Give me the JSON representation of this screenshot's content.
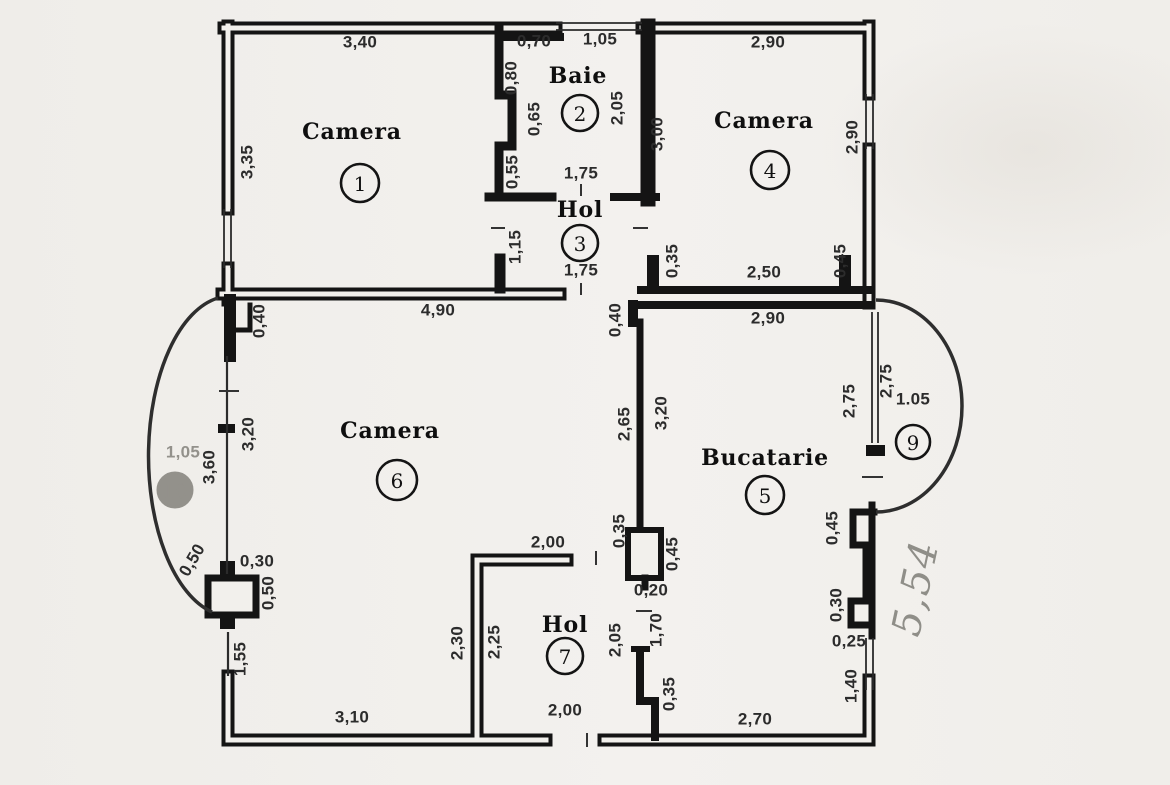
{
  "drawing": {
    "title_hint": "apartment floor plan (scanned)",
    "colors": {
      "paper": "#f2f0ec",
      "ink": "#141414",
      "pencil": "#8f8e88"
    },
    "rooms": [
      {
        "name": "Camera",
        "number": "1",
        "name_x": 352,
        "name_y": 132,
        "num_x": 360,
        "num_y": 183,
        "r": 19,
        "faint": false
      },
      {
        "name": "Baie",
        "number": "2",
        "name_x": 578,
        "name_y": 76,
        "num_x": 580,
        "num_y": 113,
        "r": 18,
        "faint": false
      },
      {
        "name": "Hol",
        "number": "3",
        "name_x": 580,
        "name_y": 210,
        "num_x": 580,
        "num_y": 243,
        "r": 18,
        "faint": false
      },
      {
        "name": "Camera",
        "number": "4",
        "name_x": 764,
        "name_y": 121,
        "num_x": 770,
        "num_y": 170,
        "r": 19,
        "faint": false
      },
      {
        "name": "Bucatarie",
        "number": "5",
        "name_x": 765,
        "name_y": 458,
        "num_x": 765,
        "num_y": 495,
        "r": 19,
        "faint": false
      },
      {
        "name": "Camera",
        "number": "6",
        "name_x": 390,
        "name_y": 431,
        "num_x": 397,
        "num_y": 480,
        "r": 20,
        "faint": false
      },
      {
        "name": "Hol",
        "number": "7",
        "name_x": 565,
        "name_y": 625,
        "num_x": 565,
        "num_y": 656,
        "r": 18,
        "faint": false
      },
      {
        "name": "",
        "number": "9",
        "name_x": 0,
        "name_y": 0,
        "num_x": 913,
        "num_y": 442,
        "r": 17,
        "faint": false
      },
      {
        "name": "",
        "number": "10",
        "name_x": 0,
        "name_y": 0,
        "num_x": 175,
        "num_y": 490,
        "r": 17,
        "faint": true
      }
    ],
    "dimensions": [
      {
        "text": "3,40",
        "x": 360,
        "y": 42,
        "rot": 0,
        "faint": false
      },
      {
        "text": "0,70",
        "x": 534,
        "y": 41,
        "rot": 0,
        "faint": false
      },
      {
        "text": "1,05",
        "x": 600,
        "y": 39,
        "rot": 0,
        "faint": false
      },
      {
        "text": "2,90",
        "x": 768,
        "y": 42,
        "rot": 0,
        "faint": false
      },
      {
        "text": "3,35",
        "x": 247,
        "y": 162,
        "rot": -90,
        "faint": false
      },
      {
        "text": "0,80",
        "x": 511,
        "y": 78,
        "rot": -90,
        "faint": false
      },
      {
        "text": "0,65",
        "x": 534,
        "y": 119,
        "rot": -90,
        "faint": false
      },
      {
        "text": "0,55",
        "x": 512,
        "y": 172,
        "rot": -90,
        "faint": false
      },
      {
        "text": "2,05",
        "x": 617,
        "y": 108,
        "rot": -90,
        "faint": false
      },
      {
        "text": "3,00",
        "x": 657,
        "y": 134,
        "rot": -90,
        "faint": false
      },
      {
        "text": "2,90",
        "x": 852,
        "y": 137,
        "rot": -90,
        "faint": false
      },
      {
        "text": "1,75",
        "x": 581,
        "y": 173,
        "rot": 0,
        "faint": false
      },
      {
        "text": "1,15",
        "x": 515,
        "y": 247,
        "rot": -90,
        "faint": false
      },
      {
        "text": "1,75",
        "x": 581,
        "y": 270,
        "rot": 0,
        "faint": false
      },
      {
        "text": "0,35",
        "x": 672,
        "y": 261,
        "rot": -90,
        "faint": false
      },
      {
        "text": "2,50",
        "x": 764,
        "y": 272,
        "rot": 0,
        "faint": false
      },
      {
        "text": "0,45",
        "x": 840,
        "y": 261,
        "rot": -90,
        "faint": false
      },
      {
        "text": "4,90",
        "x": 438,
        "y": 310,
        "rot": 0,
        "faint": false
      },
      {
        "text": "0,40",
        "x": 259,
        "y": 321,
        "rot": -90,
        "faint": false
      },
      {
        "text": "2,90",
        "x": 768,
        "y": 318,
        "rot": 0,
        "faint": false
      },
      {
        "text": "0,40",
        "x": 615,
        "y": 320,
        "rot": -90,
        "faint": false
      },
      {
        "text": "2,65",
        "x": 624,
        "y": 424,
        "rot": -90,
        "faint": false
      },
      {
        "text": "3,20",
        "x": 661,
        "y": 413,
        "rot": -90,
        "faint": false
      },
      {
        "text": "2,75",
        "x": 849,
        "y": 401,
        "rot": -90,
        "faint": false
      },
      {
        "text": "2,75",
        "x": 886,
        "y": 381,
        "rot": -90,
        "faint": false
      },
      {
        "text": "1.05",
        "x": 913,
        "y": 399,
        "rot": 0,
        "faint": false
      },
      {
        "text": "3,20",
        "x": 248,
        "y": 434,
        "rot": -90,
        "faint": false
      },
      {
        "text": "3,60",
        "x": 209,
        "y": 467,
        "rot": -90,
        "faint": false
      },
      {
        "text": "1,05",
        "x": 183,
        "y": 452,
        "rot": 0,
        "faint": true
      },
      {
        "text": "0,50",
        "x": 192,
        "y": 560,
        "rot": -60,
        "faint": false
      },
      {
        "text": "0,30",
        "x": 257,
        "y": 561,
        "rot": 0,
        "faint": false
      },
      {
        "text": "0,50",
        "x": 268,
        "y": 593,
        "rot": -90,
        "faint": false
      },
      {
        "text": "1,55",
        "x": 240,
        "y": 659,
        "rot": -90,
        "faint": false
      },
      {
        "text": "0,35",
        "x": 619,
        "y": 531,
        "rot": -90,
        "faint": false
      },
      {
        "text": "0,45",
        "x": 672,
        "y": 554,
        "rot": -90,
        "faint": false
      },
      {
        "text": "0,20",
        "x": 651,
        "y": 590,
        "rot": 0,
        "faint": false
      },
      {
        "text": "0,45",
        "x": 832,
        "y": 528,
        "rot": -90,
        "faint": false
      },
      {
        "text": "0,30",
        "x": 836,
        "y": 605,
        "rot": -90,
        "faint": false
      },
      {
        "text": "0,25",
        "x": 849,
        "y": 641,
        "rot": 0,
        "faint": false
      },
      {
        "text": "1,40",
        "x": 851,
        "y": 686,
        "rot": -90,
        "faint": false
      },
      {
        "text": "2,00",
        "x": 548,
        "y": 542,
        "rot": 0,
        "faint": false
      },
      {
        "text": "2,30",
        "x": 457,
        "y": 643,
        "rot": -90,
        "faint": false
      },
      {
        "text": "2,25",
        "x": 494,
        "y": 642,
        "rot": -90,
        "faint": false
      },
      {
        "text": "2,05",
        "x": 615,
        "y": 640,
        "rot": -90,
        "faint": false
      },
      {
        "text": "1,70",
        "x": 656,
        "y": 630,
        "rot": -90,
        "faint": false
      },
      {
        "text": "0,35",
        "x": 669,
        "y": 694,
        "rot": -90,
        "faint": false
      },
      {
        "text": "2,00",
        "x": 565,
        "y": 710,
        "rot": 0,
        "faint": false
      },
      {
        "text": "3,10",
        "x": 352,
        "y": 717,
        "rot": 0,
        "faint": false
      },
      {
        "text": "2,70",
        "x": 755,
        "y": 719,
        "rot": 0,
        "faint": false
      }
    ],
    "handwritten_note": {
      "text": "5,54",
      "x": 916,
      "y": 588,
      "rot": -78
    }
  }
}
